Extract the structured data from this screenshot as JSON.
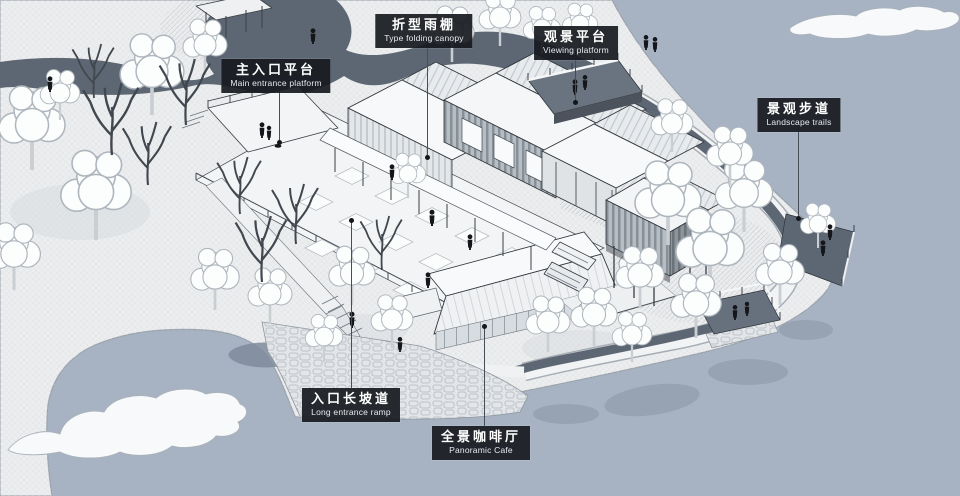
{
  "scene": {
    "description": "Axonometric site illustration of a lakeside visitor center",
    "colors": {
      "water": "#a7b3c3",
      "land": "#ecedee",
      "path": "#5d6773",
      "label_bg": "#181b20",
      "label_text": "#ffffff"
    }
  },
  "annotations": [
    {
      "id": "main-entrance-platform",
      "zh": "主入口平台",
      "en": "Main entrance platform"
    },
    {
      "id": "folding-canopy",
      "zh": "折型雨棚",
      "en": "Type folding canopy"
    },
    {
      "id": "viewing-platform",
      "zh": "观景平台",
      "en": "Viewing platform"
    },
    {
      "id": "landscape-trails",
      "zh": "景观步道",
      "en": "Landscape trails"
    },
    {
      "id": "entrance-ramp",
      "zh": "入口长坡道",
      "en": "Long entrance ramp"
    },
    {
      "id": "panoramic-cafe",
      "zh": "全景咖啡厅",
      "en": "Panoramic Cafe"
    }
  ]
}
